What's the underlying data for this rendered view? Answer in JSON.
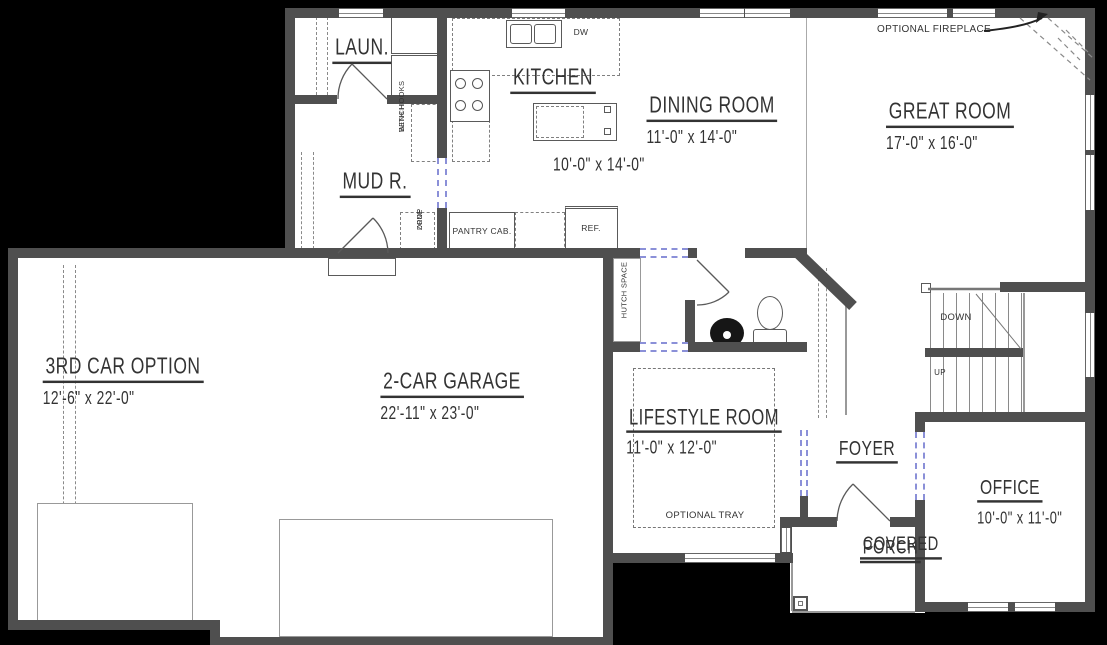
{
  "plan": {
    "title": "First floor plan",
    "rooms": {
      "laundry": {
        "name": "LAUN."
      },
      "kitchen": {
        "name": "KITCHEN",
        "dims": "10'-0\" x 14'-0\""
      },
      "dining": {
        "name": "DINING ROOM",
        "dims": "11'-0\" x 14'-0\""
      },
      "great": {
        "name": "GREAT ROOM",
        "dims": "17'-0\" x 16'-0\""
      },
      "mud": {
        "name": "MUD R."
      },
      "third_car": {
        "name": "3RD CAR OPTION",
        "dims": "12'-6\" x 22'-0\""
      },
      "garage": {
        "name": "2-CAR GARAGE",
        "dims": "22'-11\" x 23'-0\""
      },
      "lifestyle": {
        "name": "LIFESTYLE ROOM",
        "dims": "11'-0\" x 12'-0\""
      },
      "foyer": {
        "name": "FOYER"
      },
      "office": {
        "name": "OFFICE",
        "dims": "10'-0\" x 11'-0\""
      },
      "porch": {
        "name_line1": "COVERED",
        "name_line2": "PORCH"
      }
    },
    "annotations": {
      "optional_fireplace": "OPTIONAL FIREPLACE",
      "optional_tray": "OPTIONAL TRAY",
      "bench_line1": "BENCH",
      "bench_line2": "WITH HOOKS",
      "drop_line1": "DROP",
      "drop_line2": "ZONE",
      "pantry": "PANTRY CAB.",
      "ref": "REF.",
      "dw": "DW",
      "hutch": "HUTCH SPACE",
      "down": "DOWN",
      "up": "UP"
    },
    "colors": {
      "background": "#000000",
      "floor": "#ffffff",
      "wall": "#4f4f4f",
      "opening_dash": "#8b90d8",
      "ink": "#333333"
    }
  }
}
